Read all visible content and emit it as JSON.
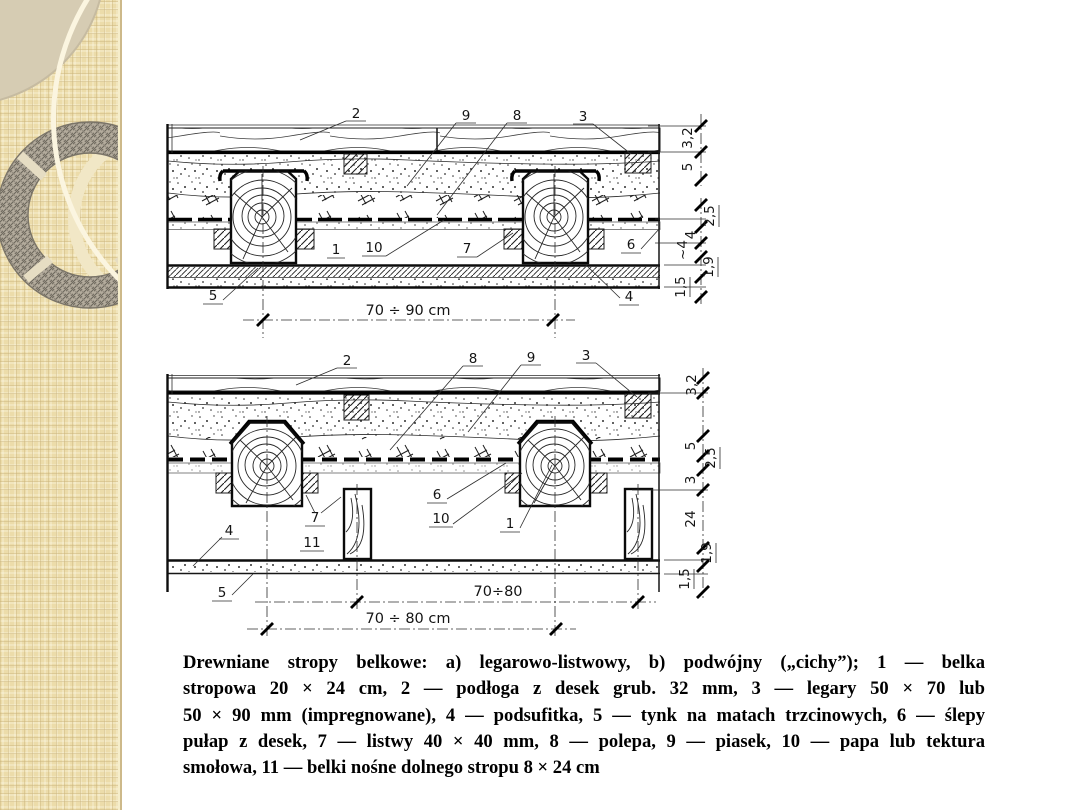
{
  "slide": {
    "background": "#ffffff",
    "sidebar_color": "#ecdcaa",
    "sidebar_accent": "#d6ccb3"
  },
  "figure": {
    "a": {
      "tag": "a)",
      "labels": {
        "n2": "2",
        "n9": "9",
        "n8": "8",
        "n3": "3",
        "n1": "1",
        "n10": "10",
        "n7": "7",
        "n6": "6",
        "n5": "5",
        "n4": "4"
      },
      "dim_span": "70 ÷ 90 cm",
      "chain": [
        "3,2",
        "5",
        "2,5",
        "4",
        "~4",
        "1,9",
        "1,5"
      ]
    },
    "b": {
      "tag": "b)",
      "labels": {
        "n2": "2",
        "n8": "8",
        "n9": "9",
        "n3": "3",
        "n6": "6",
        "n10": "10",
        "n1": "1",
        "n4": "4",
        "n7": "7",
        "n11": "11",
        "n5": "5"
      },
      "dim_lower": "70÷80",
      "dim_upper": "70 ÷ 80 cm",
      "chain": [
        "3,2",
        "5",
        "2,5",
        "3",
        "24",
        "1,9",
        "1,5"
      ]
    }
  },
  "caption": {
    "lines": [
      "Drewniane stropy belkowe: a) legarowo-listwowy, b) podwójny („cichy”); 1 — belka",
      "stropowa 20 × 24 cm, 2 — podłoga z desek grub. 32 mm, 3 — legary 50 × 70 lub",
      "50 × 90 mm (impregnowane), 4 — podsufitka, 5 — tynk na matach trzcinowych, 6 — ślepy",
      "pułap z desek, 7 — listwy 40 × 40 mm, 8 — polepa, 9 — piasek, 10 — papa lub tektura",
      "smołowa, 11 — belki nośne dolnego stropu 8 × 24 cm"
    ]
  }
}
